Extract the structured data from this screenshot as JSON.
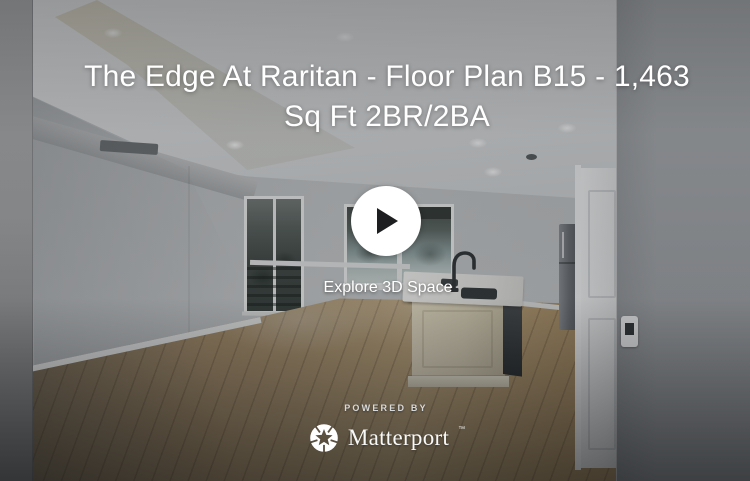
{
  "viewer": {
    "title": "The Edge At Raritan - Floor Plan B15 - 1,463 Sq Ft 2BR/2BA",
    "title_lines": [
      "The Edge At Raritan - Floor Plan B15 - 1,463",
      "Sq Ft 2BR/2BA"
    ],
    "play": {
      "explore_label": "Explore 3D Space"
    },
    "footer": {
      "powered_by": "POWERED BY",
      "brand": "Matterport",
      "trademark": "™"
    }
  },
  "colors": {
    "overlay_text": "#ffffff",
    "play_button_bg": "#ffffff",
    "play_triangle": "#1d1e20",
    "scrim": "rgba(10,12,14,0.25)",
    "wood_floor": "#a8906e",
    "walls": "#9a9da0"
  },
  "icons": [
    {
      "name": "play-icon",
      "meaning": "start 3D tour"
    },
    {
      "name": "matterport-pinwheel-icon",
      "meaning": "Matterport brand mark"
    }
  ],
  "scene": {
    "description": "Empty apartment interior: gray walls, white ceiling with recessed lights, sliding glass door and window to trees, kitchen island with sink and faucet, stainless refrigerator, white interior door, wood plank flooring"
  }
}
